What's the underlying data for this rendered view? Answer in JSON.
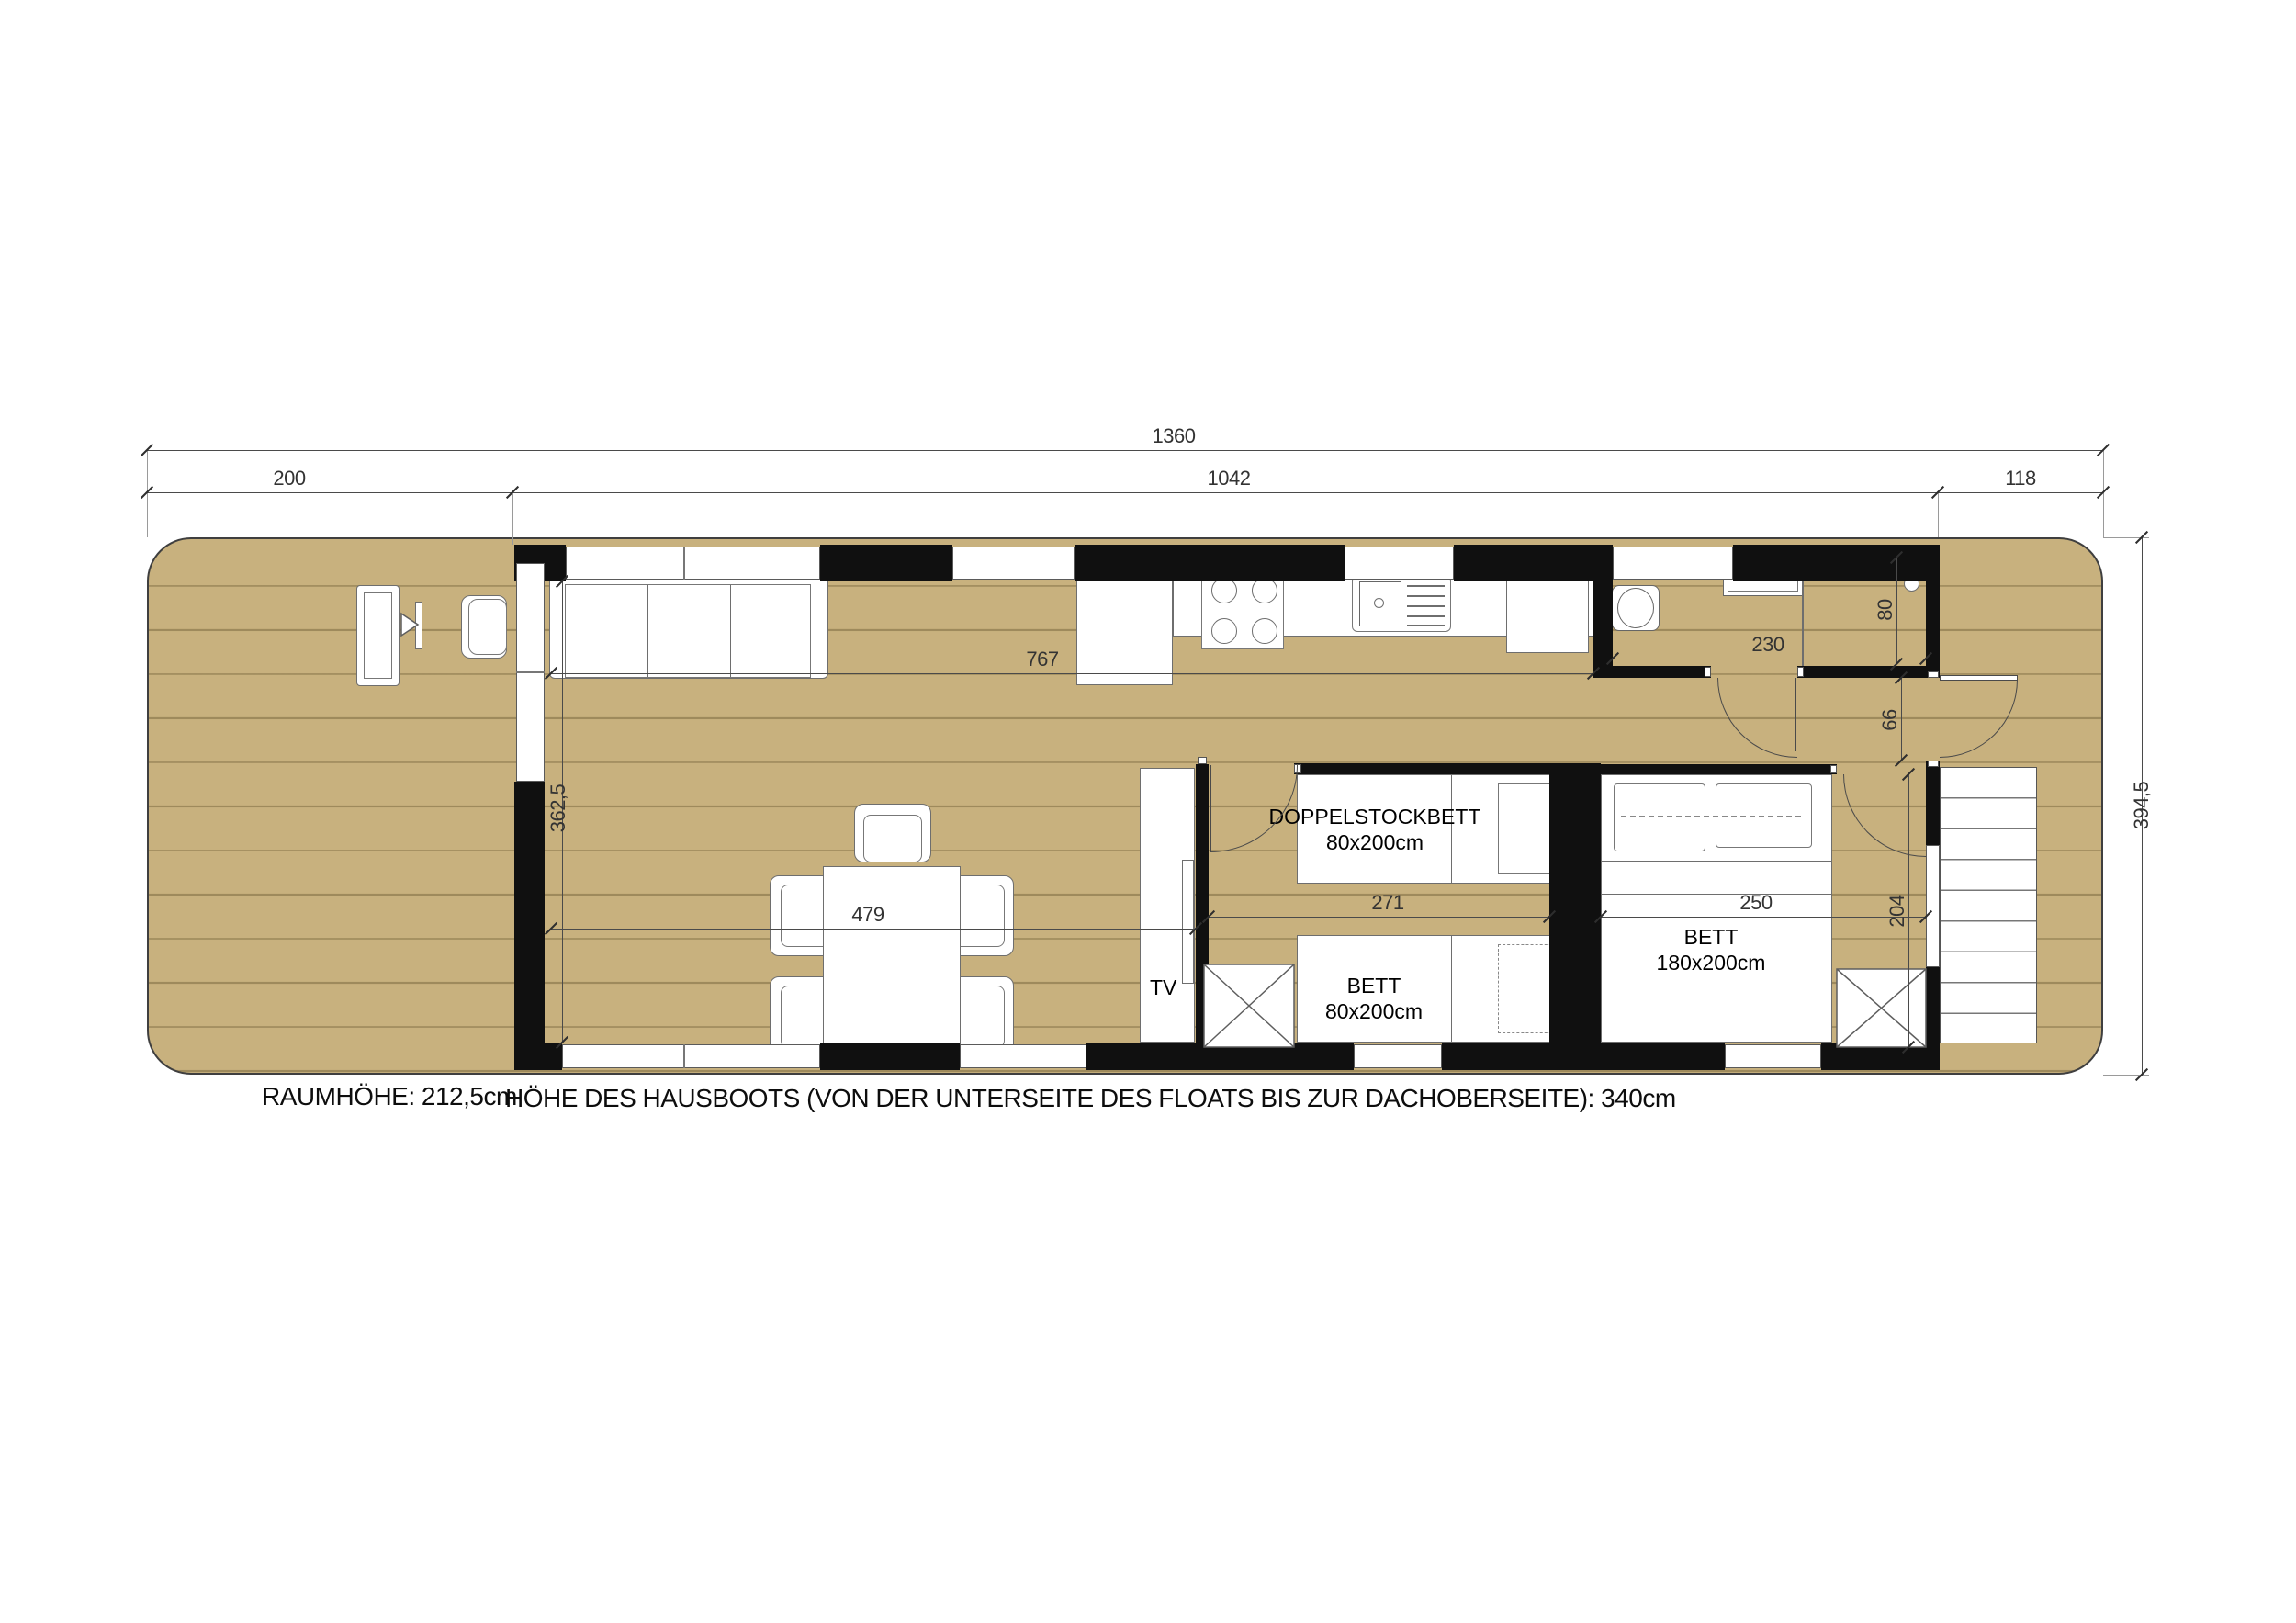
{
  "colors": {
    "deck": "#c8b17e",
    "wall": "#101010"
  },
  "dims": {
    "total_width": "1360",
    "terrace_width": "200",
    "cabin_width": "1042",
    "stairs_width": "118",
    "total_depth": "394,5",
    "living_kitchen_length": "767",
    "living_depth": "362,5",
    "living_length": "479",
    "kids_room_width": "271",
    "master_room_width": "250",
    "bathroom_width": "230",
    "shower_width": "80",
    "entry_door_width": "66",
    "master_room_depth": "204"
  },
  "labels": {
    "bunk_bed_name": "DOPPELSTOCKBETT",
    "bunk_bed_size": "80x200cm",
    "single_bed_name": "BETT",
    "single_bed_size": "80x200cm",
    "double_bed_name": "BETT",
    "double_bed_size": "180x200cm",
    "tv": "TV"
  },
  "footer": {
    "room_height": "RAUMHÖHE: 212,5cm",
    "boat_height": "HÖHE DES HAUSBOOTS (VON DER UNTERSEITE DES FLOATS BIS ZUR DACHOBERSEITE): 340cm"
  }
}
